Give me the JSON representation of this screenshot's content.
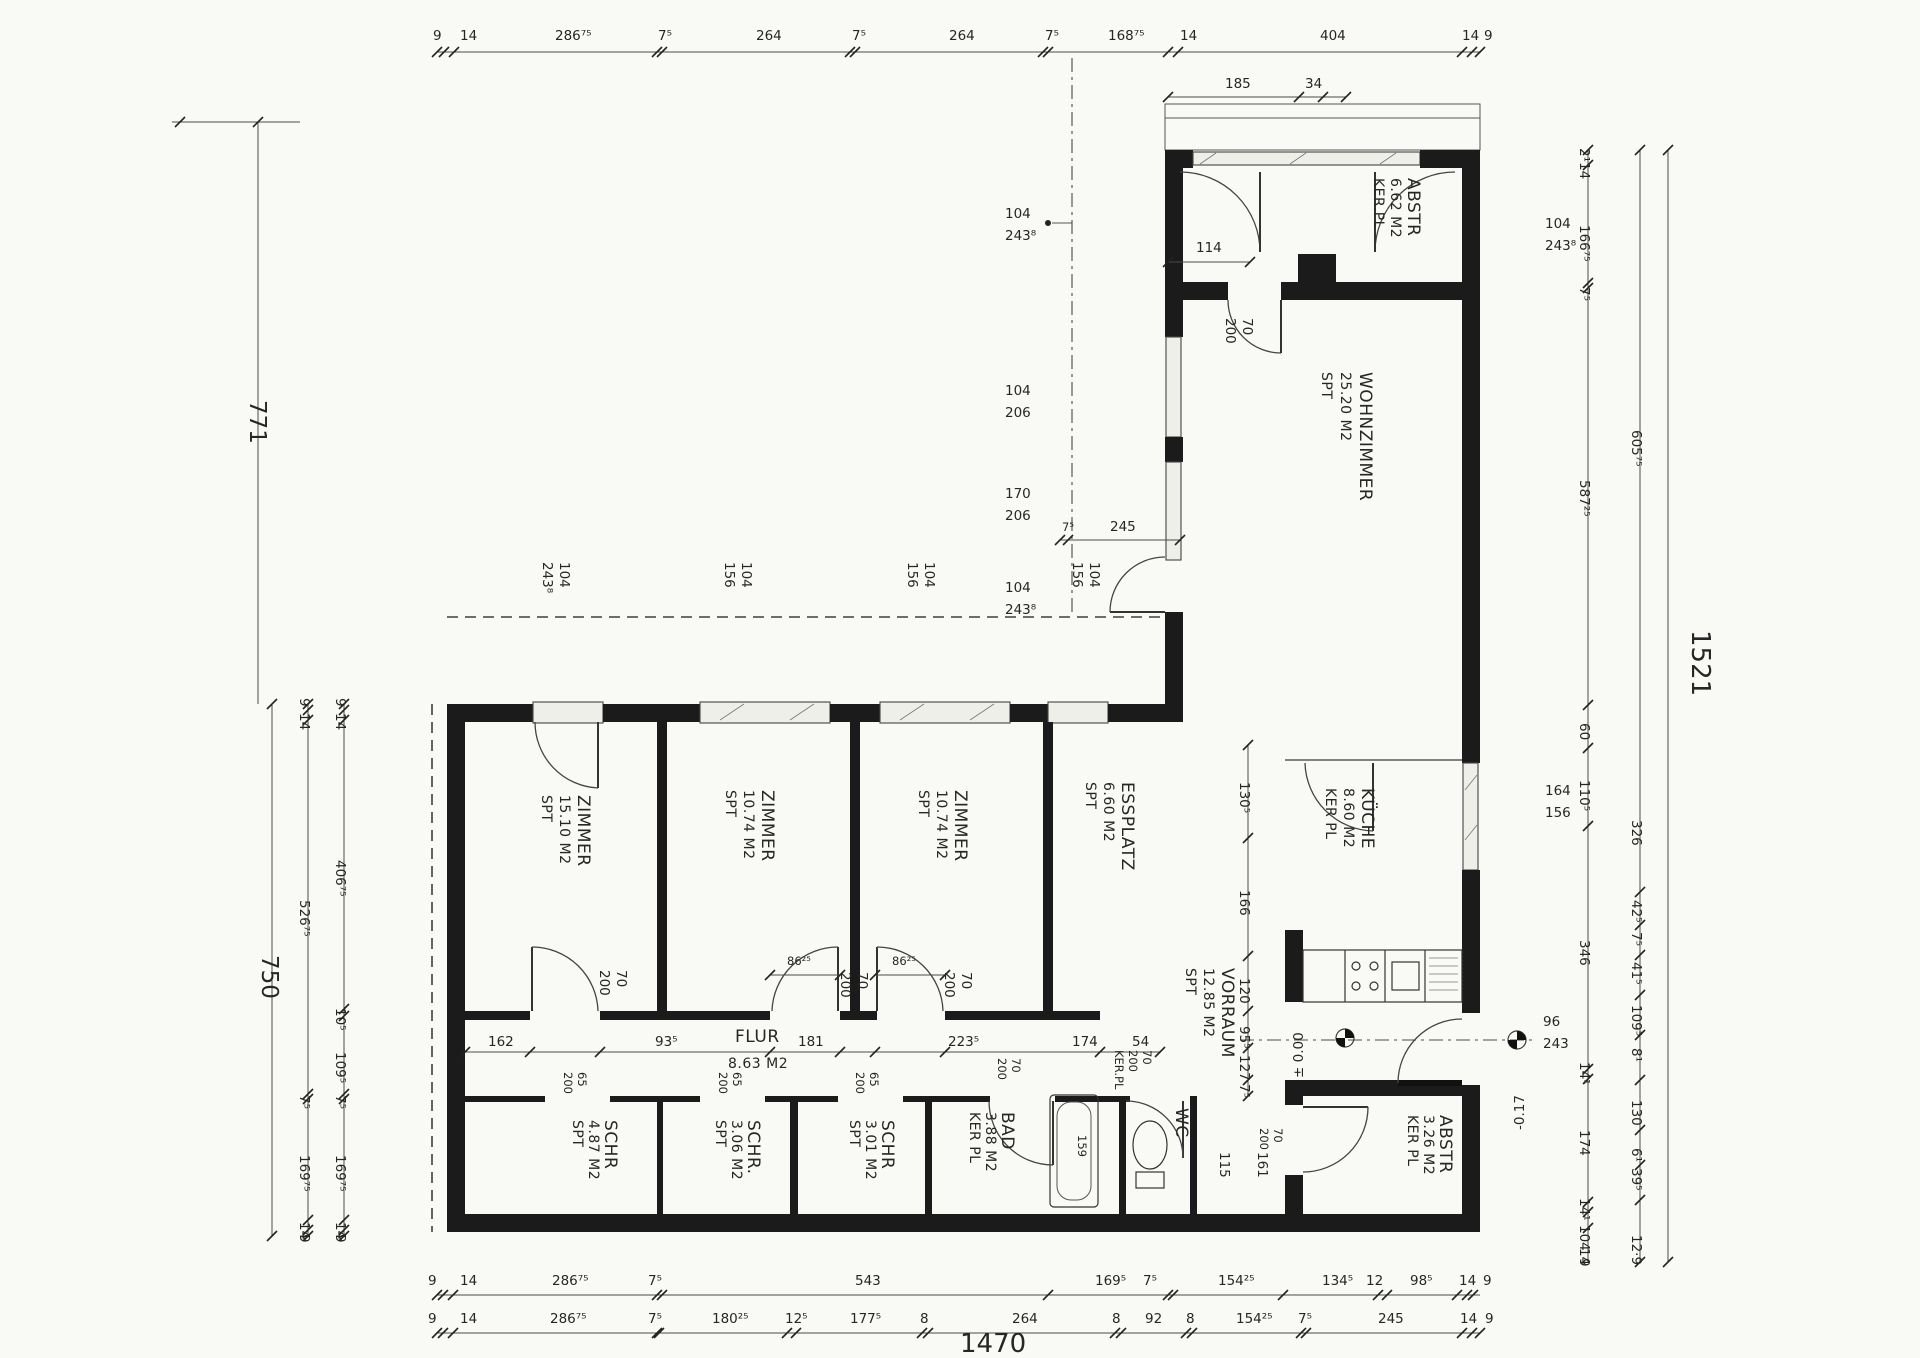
{
  "rooms": {
    "abstr_top": {
      "name": "ABSTR",
      "area": "6.62 M2",
      "floor": "KER.PL"
    },
    "wohnzimmer": {
      "name": "WOHNZIMMER",
      "area": "25.20 M2",
      "floor": "SPT"
    },
    "kueche": {
      "name": "KÜCHE",
      "area": "8.60 M2",
      "floor": "KER PL"
    },
    "zimmer1": {
      "name": "ZIMMER",
      "area": "15.10 M2",
      "floor": "SPT"
    },
    "zimmer2": {
      "name": "ZIMMER",
      "area": "10.74 M2",
      "floor": "SPT"
    },
    "zimmer3": {
      "name": "ZIMMER",
      "area": "10.74 M2",
      "floor": "SPT"
    },
    "essplatz": {
      "name": "ESSPLATZ",
      "area": "6.60 M2",
      "floor": "SPT"
    },
    "vorraum": {
      "name": "VORRAUM",
      "area": "12.85 M2",
      "floor": "SPT"
    },
    "flur": {
      "name": "FLUR",
      "area": "8.63 M2",
      "floor": "SPT"
    },
    "schr1": {
      "name": "SCHR",
      "area": "4.87 M2",
      "floor": "SPT"
    },
    "schr2": {
      "name": "SCHR.",
      "area": "3.06 M2",
      "floor": "SPT"
    },
    "schr3": {
      "name": "SCHR",
      "area": "3.01 M2",
      "floor": "SPT"
    },
    "bad": {
      "name": "BAD",
      "area": "3.88 M2",
      "floor": "KER PL"
    },
    "wc": {
      "name": "WC",
      "floor": "KER.PL"
    },
    "abstr_bottom": {
      "name": "ABSTR",
      "area": "3.26 M2",
      "floor": "KER PL"
    }
  },
  "dims": {
    "top": [
      "9",
      "14",
      "286⁷⁵",
      "7⁵",
      "264",
      "7⁵",
      "264",
      "7⁵",
      "168⁷⁵",
      "14",
      "404",
      "14",
      "9"
    ],
    "top_sub": [
      "185",
      "34"
    ],
    "bottom1": [
      "9",
      "14",
      "286⁷⁵",
      "7⁵",
      "543",
      "169⁵",
      "7⁵",
      "154²⁵",
      "134⁵",
      "12",
      "98⁵",
      "14",
      "9"
    ],
    "bottom2": [
      "9",
      "14",
      "286⁷⁵",
      "7⁵",
      "180²⁵",
      "12⁵",
      "177⁵",
      "8",
      "264",
      "8",
      "92",
      "8",
      "154²⁵",
      "7⁵",
      "245",
      "14",
      "9"
    ],
    "bottom_total": "1470",
    "left1": [
      "9",
      "14",
      "406⁷⁵",
      "10⁵",
      "109⁵",
      "7⁵",
      "169⁷⁵",
      "14",
      "9"
    ],
    "left2": [
      "9",
      "14",
      "526⁷⁵",
      "7⁵",
      "169⁷⁵",
      "14",
      "9"
    ],
    "left_total": "750",
    "left_height": "771",
    "right1": [
      "2¹",
      "14",
      "166⁷⁵",
      "7⁵",
      "587²⁵",
      "60",
      "110⁵",
      "346",
      "14¹",
      "174",
      "14¹",
      "104",
      "14",
      "9"
    ],
    "right2": [
      "605⁷⁵",
      "326",
      "42⁵",
      "7⁵",
      "41⁵",
      "109⁵",
      "8¹",
      "130",
      "6¹",
      "39⁵",
      "12·9"
    ],
    "right_total": "1521",
    "vorraum_chain": [
      "130⁵",
      "166",
      "120"
    ],
    "vorraum_sub": [
      "95⁵",
      "127",
      "7⁵"
    ],
    "flur_chain": [
      "162",
      "93⁵",
      "181",
      "223⁵",
      "174",
      "54"
    ],
    "vest1": "115",
    "vest2": "161",
    "abstr_door_width": "114",
    "wohn_door_jamb": "7⁵",
    "wohn_door": "245"
  },
  "windows": {
    "z1": {
      "w": "104",
      "h": "243⁸"
    },
    "z2": {
      "w": "104",
      "h": "156"
    },
    "z3": {
      "w": "104",
      "h": "156"
    },
    "ess": {
      "w": "104",
      "h": "156"
    },
    "wz1": {
      "w": "104",
      "h": "243⁸"
    },
    "wz2": {
      "w": "104",
      "h": "206"
    },
    "wz3": {
      "w": "170",
      "h": "206"
    },
    "wz4": {
      "w": "104",
      "h": "243⁸"
    },
    "abstr": {
      "w": "104",
      "h": "243⁸"
    },
    "kueche": {
      "w": "164",
      "h": "156"
    }
  },
  "doors": {
    "standard": {
      "w": "70",
      "h": "200"
    },
    "closet": {
      "w": "65",
      "h": "200"
    },
    "wc_floor": "KER.PL",
    "entry": {
      "w": "96",
      "h": "243"
    },
    "lintel": "86²⁵",
    "tub_len": "159"
  },
  "levels": {
    "zero": "± 0.00",
    "entry": "-0.17"
  }
}
